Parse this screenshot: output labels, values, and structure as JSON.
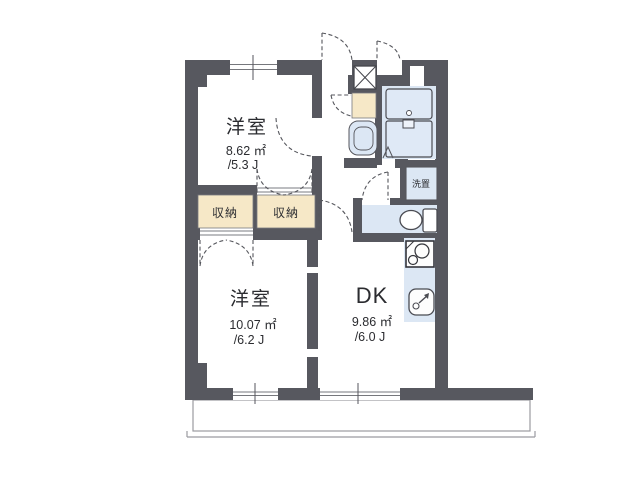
{
  "rooms": {
    "bedroom_upper": {
      "name": "洋室",
      "area": "8.62 ㎡",
      "size": "/5.3 J"
    },
    "bedroom_lower": {
      "name": "洋室",
      "area": "10.07 ㎡",
      "size": "/6.2 J"
    },
    "dk": {
      "name": "DK",
      "area": "9.86 ㎡",
      "size": "/6.0 J"
    }
  },
  "closets": {
    "left": {
      "label": "収納"
    },
    "right": {
      "label": "収納"
    }
  },
  "laundry": {
    "label": "洗置"
  },
  "colors": {
    "wall": "#57585f",
    "closet_fill": "#f6e8c7",
    "water_fill": "#dce7f4",
    "fixture_fill": "#dfe9f6",
    "fixture_line": "#4a4b52",
    "balcony_line": "#9b9ba1"
  }
}
